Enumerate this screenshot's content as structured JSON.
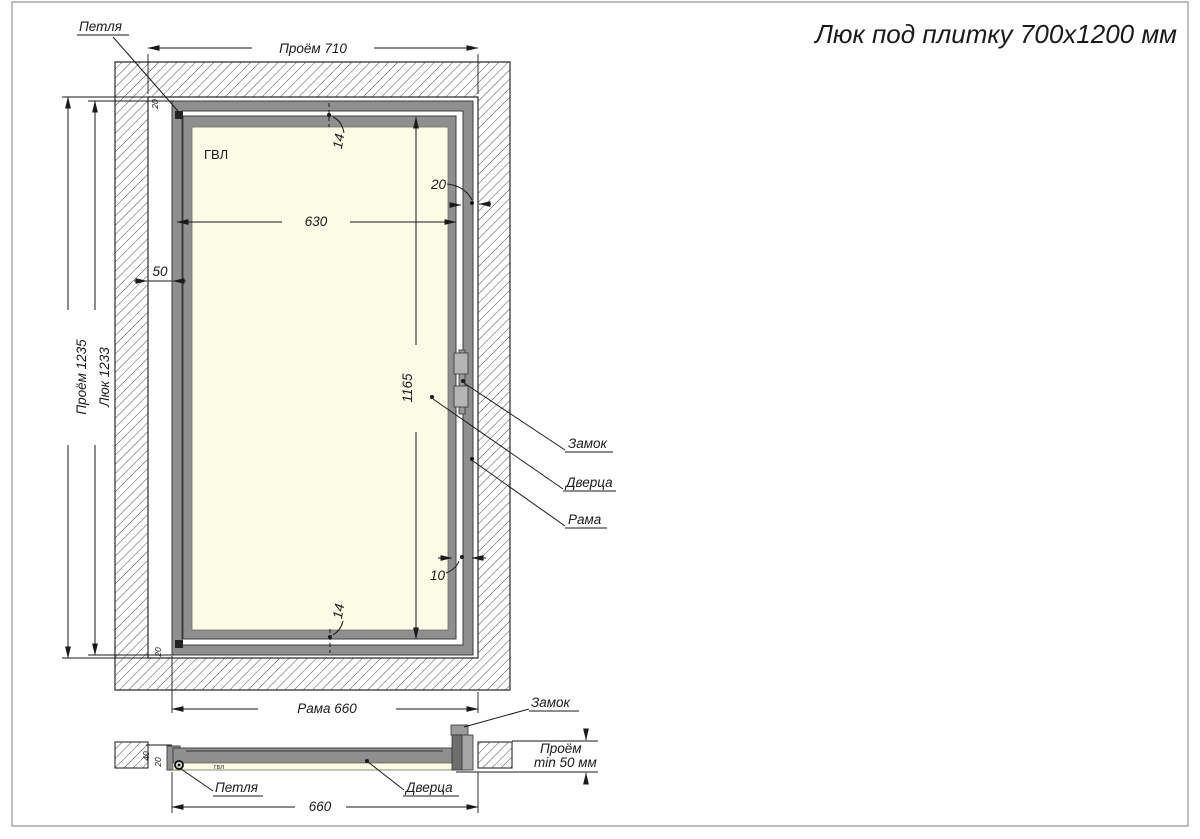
{
  "title": "Люк под плитку 700х1200 мм",
  "colors": {
    "frame_gray": "#8f8f8f",
    "panel_cream": "#fbfbe6",
    "lock_light_gray": "#b5b5b5",
    "line_dark": "#1a1a1a"
  },
  "front_view": {
    "hinge_label": "Петля",
    "opening_width_label": "Проём 710",
    "opening_height_label": "Проём 1235",
    "hatch_height_label": "Люк 1233",
    "panel_material_label": "ГВЛ",
    "top_left_offset": "20",
    "bottom_left_offset": "20",
    "top_gap": "14",
    "bottom_gap": "14",
    "door_width": "630",
    "left_gap": "50",
    "door_height": "1165",
    "right_frame_offset": "20",
    "bottom_right_gap": "10",
    "lock_label": "Замок",
    "door_label": "Дверца",
    "frame_label": "Рама",
    "frame_width_label": "Рама 660"
  },
  "section_view": {
    "lock_label": "Замок",
    "opening_depth_line1": "Проём",
    "opening_depth_line2": "min 50 мм",
    "hinge_label": "Петля",
    "door_label": "Дверца",
    "frame_width": "660",
    "panel_material_label": "гвл",
    "profile_height": "40",
    "panel_thickness": "20"
  }
}
